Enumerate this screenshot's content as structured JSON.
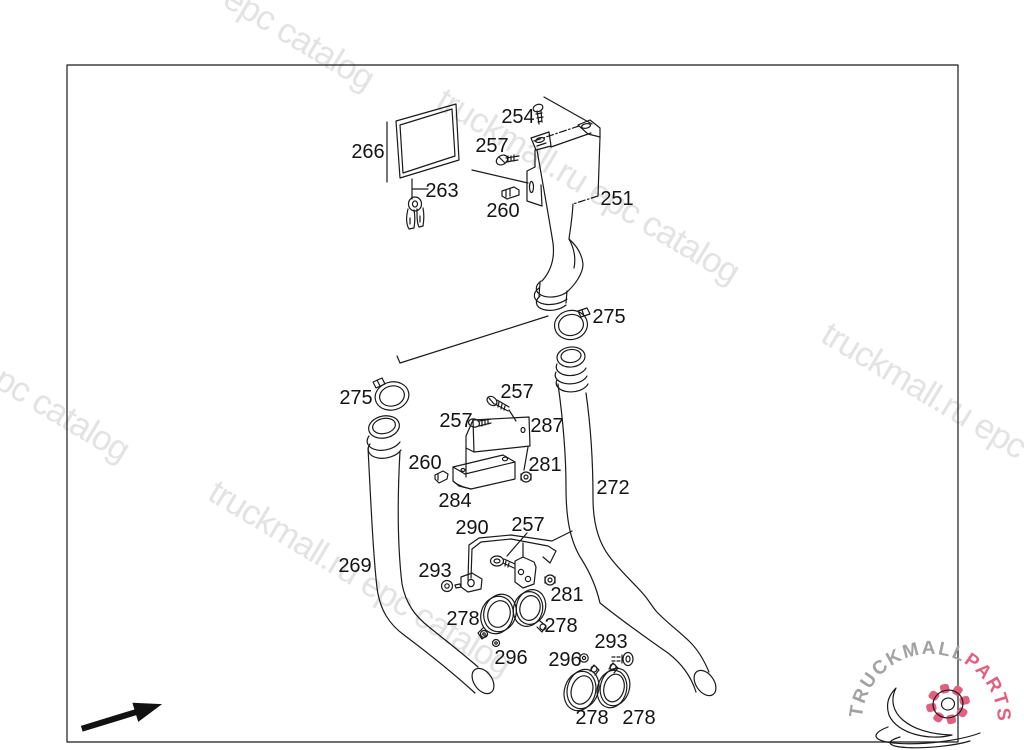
{
  "diagram": {
    "type": "exploded-parts-diagram",
    "line_color": "#1a1a1a",
    "part_labels": [
      {
        "text": "254",
        "x": 518,
        "y": 123
      },
      {
        "text": "257",
        "x": 492,
        "y": 152
      },
      {
        "text": "266",
        "x": 368,
        "y": 158
      },
      {
        "text": "263",
        "x": 442,
        "y": 197
      },
      {
        "text": "260",
        "x": 503,
        "y": 217
      },
      {
        "text": "251",
        "x": 617,
        "y": 205
      },
      {
        "text": "275",
        "x": 609,
        "y": 323
      },
      {
        "text": "275",
        "x": 356,
        "y": 404
      },
      {
        "text": "257",
        "x": 517,
        "y": 398
      },
      {
        "text": "257",
        "x": 456,
        "y": 427
      },
      {
        "text": "287",
        "x": 547,
        "y": 432
      },
      {
        "text": "260",
        "x": 425,
        "y": 469
      },
      {
        "text": "281",
        "x": 545,
        "y": 471
      },
      {
        "text": "284",
        "x": 455,
        "y": 507
      },
      {
        "text": "272",
        "x": 613,
        "y": 494
      },
      {
        "text": "269",
        "x": 355,
        "y": 572
      },
      {
        "text": "290",
        "x": 472,
        "y": 534
      },
      {
        "text": "257",
        "x": 528,
        "y": 531
      },
      {
        "text": "293",
        "x": 435,
        "y": 577
      },
      {
        "text": "281",
        "x": 567,
        "y": 601
      },
      {
        "text": "278",
        "x": 463,
        "y": 625
      },
      {
        "text": "278",
        "x": 561,
        "y": 632
      },
      {
        "text": "296",
        "x": 511,
        "y": 664
      },
      {
        "text": "296",
        "x": 565,
        "y": 666
      },
      {
        "text": "293",
        "x": 611,
        "y": 648
      },
      {
        "text": "278",
        "x": 592,
        "y": 724
      },
      {
        "text": "278",
        "x": 639,
        "y": 724
      }
    ]
  },
  "watermarks": {
    "full": "truckmall.ru epc catalog",
    "short": "epc catalog",
    "color": "#e3e3e3"
  },
  "logo": {
    "brand": "TRUCKMALL",
    "suffix": "PARTS",
    "brand_color": "#a2a2a2",
    "accent_color": "#e25f80"
  }
}
